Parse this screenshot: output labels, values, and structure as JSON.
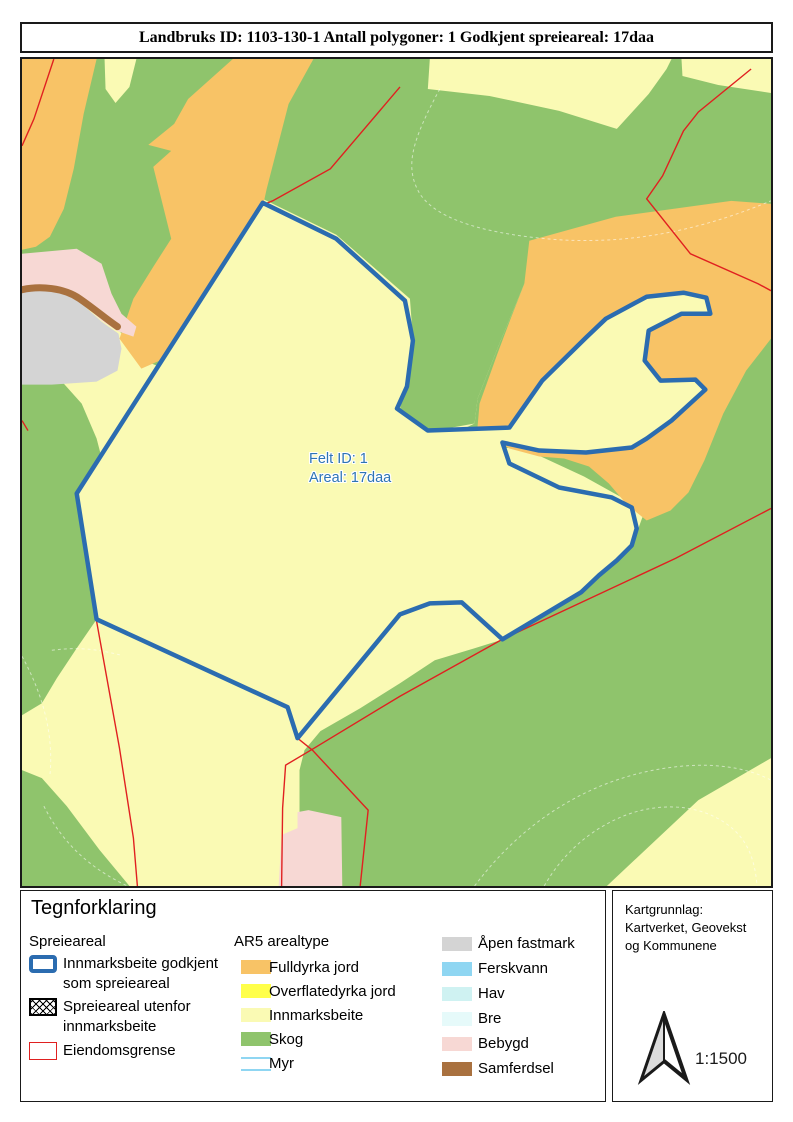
{
  "title": "Landbruks ID: 1103-130-1 Antall polygoner: 1 Godkjent spreieareal: 17daa",
  "map": {
    "label": {
      "line1": "Felt ID: 1",
      "line2": "Areal: 17daa"
    }
  },
  "legend": {
    "heading": "Tegnforklaring",
    "col1": {
      "heading": "Spreieareal",
      "items": [
        {
          "label1": "Innmarksbeite godkjent",
          "label2": "som spreieareal"
        },
        {
          "label1": "Spreieareal utenfor",
          "label2": "innmarksbeite"
        },
        {
          "label1": "Eiendomsgrense",
          "label2": ""
        }
      ]
    },
    "col2": {
      "heading": "AR5 arealtype",
      "items": [
        {
          "label": "Fulldyrka jord"
        },
        {
          "label": "Overflatedyrka jord"
        },
        {
          "label": "Innmarksbeite"
        },
        {
          "label": "Skog"
        },
        {
          "label": "Myr"
        }
      ]
    },
    "col3": {
      "items": [
        {
          "label": "Åpen fastmark"
        },
        {
          "label": "Ferskvann"
        },
        {
          "label": "Hav"
        },
        {
          "label": "Bre"
        },
        {
          "label": "Bebygd"
        },
        {
          "label": "Samferdsel"
        }
      ]
    }
  },
  "kart": {
    "line1": "Kartgrunnlag:",
    "line2": "Kartverket, Geovekst",
    "line3": "og Kommunene",
    "scale": "1:1500"
  },
  "palette": {
    "innmarksbeite": "#FAFAB4",
    "skog": "#8FC46C",
    "fulldyrka": "#F8C366",
    "overflatedyrka": "#FFFF4A",
    "apen-fastmark": "#D4D4D4",
    "ferskvann": "#8FD6F2",
    "hav": "#CFF2F2",
    "bre": "#E6FAFA",
    "bebygd": "#F7D8D4",
    "samferdsel": "#A9713F",
    "boundary-blue": "#2B6CB0",
    "property-red": "#E02020",
    "label-blue": "#2E74B5"
  }
}
